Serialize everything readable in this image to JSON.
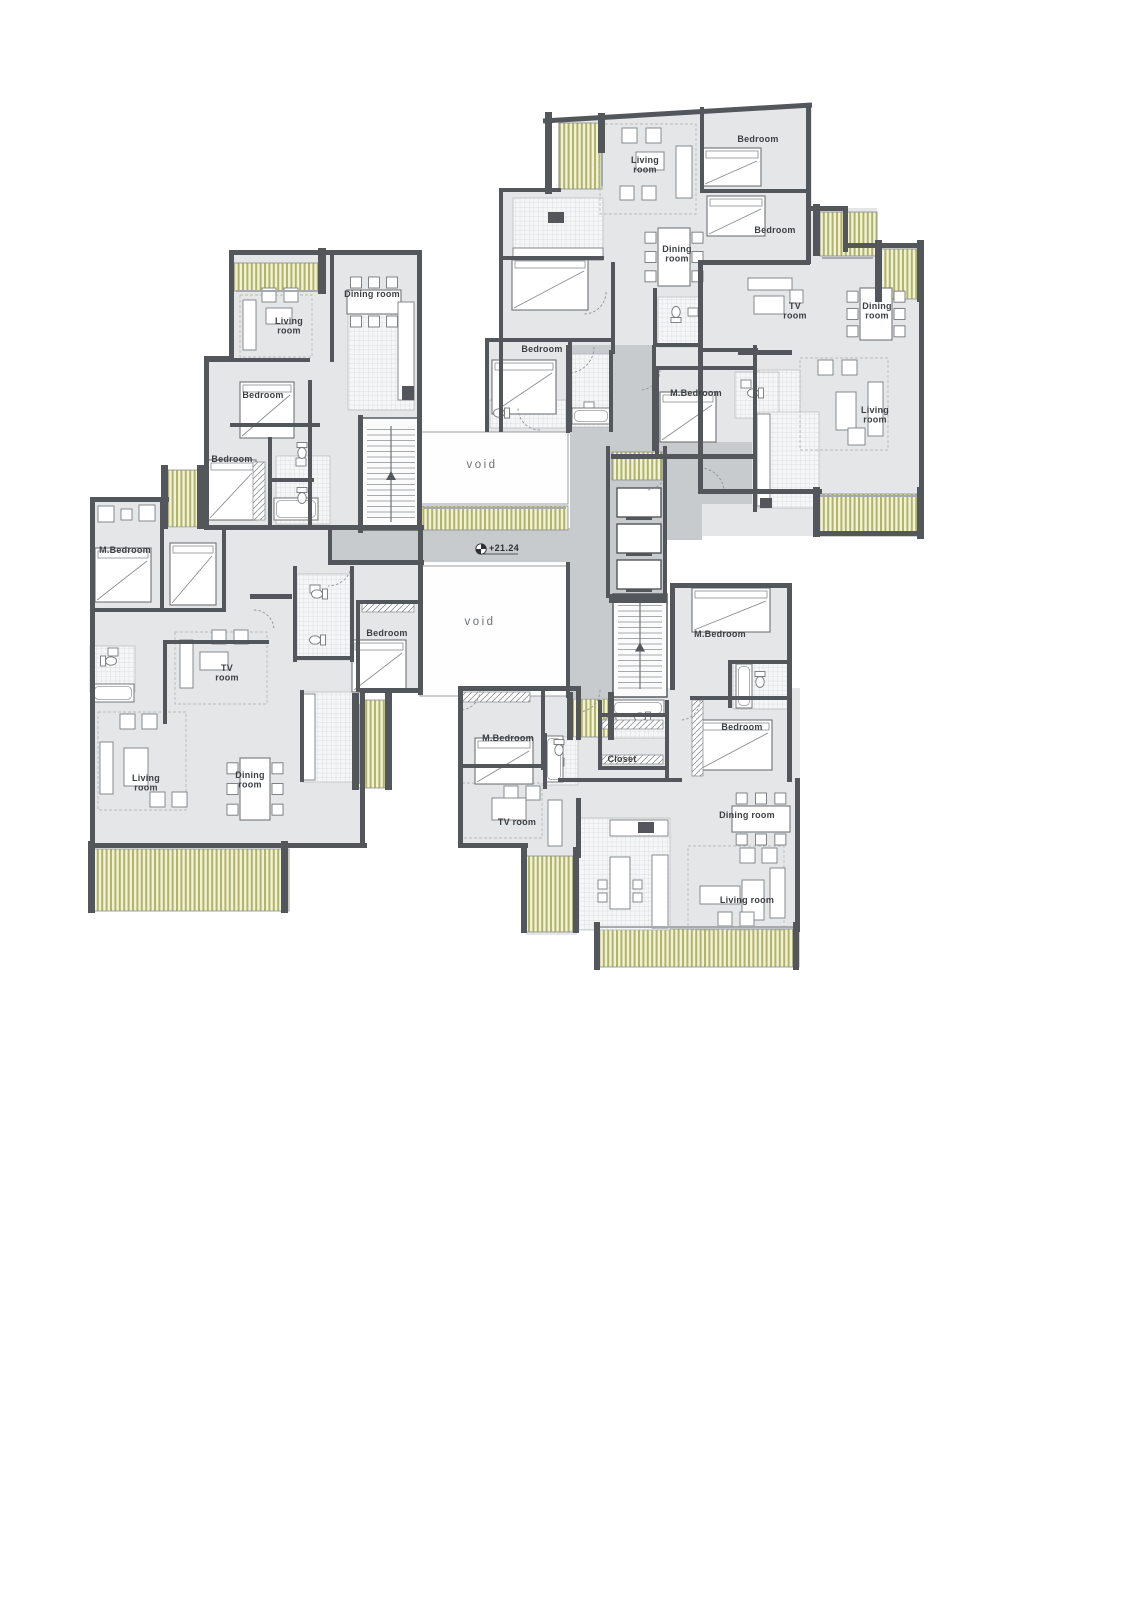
{
  "plan": {
    "marker": {
      "text": "+21.24"
    },
    "void_labels": [
      {
        "text": "void",
        "x": 482,
        "y": 468
      },
      {
        "text": "void",
        "x": 480,
        "y": 625
      }
    ],
    "rooms": [
      {
        "id": "living-room-top",
        "lines": [
          "Living",
          "room"
        ],
        "x": 645,
        "y": 163
      },
      {
        "id": "bedroom-top-1",
        "lines": [
          "Bedroom"
        ],
        "x": 758,
        "y": 142
      },
      {
        "id": "bedroom-top-2",
        "lines": [
          "Bedroom"
        ],
        "x": 775,
        "y": 233
      },
      {
        "id": "dining-room-top",
        "lines": [
          "Dining",
          "room"
        ],
        "x": 677,
        "y": 252
      },
      {
        "id": "bedroom-top-3",
        "lines": [
          "Bedroom"
        ],
        "x": 542,
        "y": 352
      },
      {
        "id": "m-bedroom-top",
        "lines": [
          "M.Bedroom"
        ],
        "x": 696,
        "y": 396
      },
      {
        "id": "tv-room-right",
        "lines": [
          "TV",
          "room"
        ],
        "x": 795,
        "y": 309
      },
      {
        "id": "dining-room-right",
        "lines": [
          "Dining",
          "room"
        ],
        "x": 877,
        "y": 309
      },
      {
        "id": "living-room-right",
        "lines": [
          "Living",
          "room"
        ],
        "x": 875,
        "y": 413
      },
      {
        "id": "dining-room-topleft",
        "lines": [
          "Dining room"
        ],
        "x": 372,
        "y": 297
      },
      {
        "id": "living-room-topleft",
        "lines": [
          "Living",
          "room"
        ],
        "x": 289,
        "y": 324
      },
      {
        "id": "bedroom-topleft-1",
        "lines": [
          "Bedroom"
        ],
        "x": 263,
        "y": 398
      },
      {
        "id": "bedroom-topleft-2",
        "lines": [
          "Bedroom"
        ],
        "x": 232,
        "y": 462
      },
      {
        "id": "m-bedroom-left",
        "lines": [
          "M.Bedroom"
        ],
        "x": 125,
        "y": 553
      },
      {
        "id": "bedroom-left",
        "lines": [
          "Bedroom"
        ],
        "x": 387,
        "y": 636
      },
      {
        "id": "tv-room-left",
        "lines": [
          "TV",
          "room"
        ],
        "x": 227,
        "y": 671
      },
      {
        "id": "living-room-left",
        "lines": [
          "Living",
          "room"
        ],
        "x": 146,
        "y": 781
      },
      {
        "id": "dining-room-left",
        "lines": [
          "Dining",
          "room"
        ],
        "x": 250,
        "y": 778
      },
      {
        "id": "m-bedroom-bottomright",
        "lines": [
          "M.Bedroom"
        ],
        "x": 720,
        "y": 637
      },
      {
        "id": "bedroom-bottomright",
        "lines": [
          "Bedroom"
        ],
        "x": 742,
        "y": 730
      },
      {
        "id": "m-bedroom-bottom",
        "lines": [
          "M.Bedroom"
        ],
        "x": 508,
        "y": 741
      },
      {
        "id": "closet-bottom",
        "lines": [
          "Closet"
        ],
        "x": 622,
        "y": 762
      },
      {
        "id": "tv-room-bottom",
        "lines": [
          "TV  room"
        ],
        "x": 517,
        "y": 825
      },
      {
        "id": "dining-room-bottom",
        "lines": [
          "Dining  room"
        ],
        "x": 747,
        "y": 818
      },
      {
        "id": "living-room-bottom",
        "lines": [
          "Living  room"
        ],
        "x": 747,
        "y": 903
      }
    ],
    "colors": {
      "wall": "#53565a",
      "floor": "#e4e6e8",
      "corridor": "#c7cbcd",
      "void": "#ffffff",
      "balcony_stripe": "#b2b55e",
      "balcony_bg": "#f0f1e0",
      "label": "#3d4043"
    }
  }
}
